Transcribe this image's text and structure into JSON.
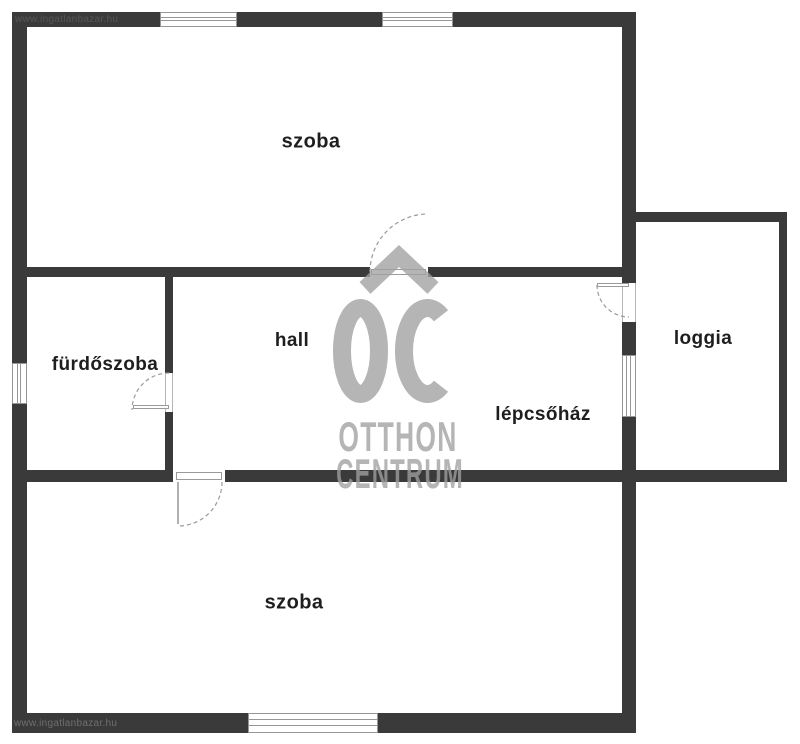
{
  "watermark": {
    "site_url_top": "www.ingatlanbazar.hu",
    "site_url_bottom": "www.ingatlanbazar.hu",
    "logo_monogram": "OC",
    "logo_line1": "OTTHON",
    "logo_line2": "CENTRUM"
  },
  "rooms": {
    "szoba_top": {
      "label": "szoba"
    },
    "furdoszoba": {
      "label": "fürdőszoba"
    },
    "hall": {
      "label": "hall"
    },
    "lepcsohaz": {
      "label": "lépcsőház"
    },
    "loggia": {
      "label": "loggia"
    },
    "szoba_bottom": {
      "label": "szoba"
    }
  },
  "colors": {
    "wall": "#3a3a3a",
    "background": "#ffffff",
    "label_text": "#1e1e1e",
    "watermark_gray": "#b6b6b6",
    "frame_gray": "#969696"
  }
}
